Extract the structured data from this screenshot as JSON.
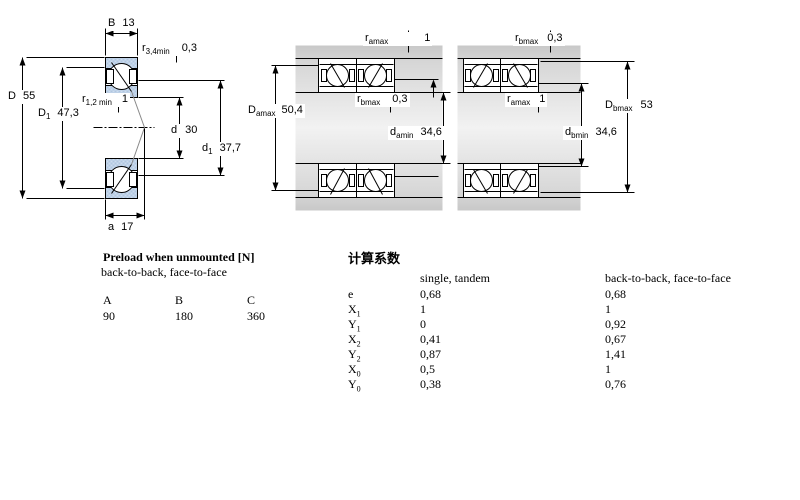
{
  "drawing": {
    "single": {
      "B": {
        "name": "B",
        "sub": "",
        "value": "13"
      },
      "r34": {
        "name": "r",
        "sub": "3,4min",
        "value": "0,3"
      },
      "D": {
        "name": "D",
        "sub": "",
        "value": "55"
      },
      "r12": {
        "name": "r",
        "sub": "1,2 min",
        "value": "1"
      },
      "D1": {
        "name": "D",
        "sub": "1",
        "value": "47,3"
      },
      "d": {
        "name": "d",
        "sub": "",
        "value": "30"
      },
      "d1": {
        "name": "d",
        "sub": "1",
        "value": "37,7"
      },
      "a": {
        "name": "a",
        "sub": "",
        "value": "17"
      }
    },
    "pair_a": {
      "ramax": {
        "name": "r",
        "sub": "amax",
        "value": "1"
      },
      "Damax": {
        "name": "D",
        "sub": "amax",
        "value": "50,4"
      },
      "rbmax": {
        "name": "r",
        "sub": "bmax",
        "value": "0,3"
      },
      "damin": {
        "name": "d",
        "sub": "amin",
        "value": "34,6"
      }
    },
    "pair_b": {
      "rbmax": {
        "name": "r",
        "sub": "bmax",
        "value": "0,3"
      },
      "ramax": {
        "name": "r",
        "sub": "amax",
        "value": "1"
      },
      "dbmin": {
        "name": "d",
        "sub": "bmin",
        "value": "34,6"
      },
      "Dbmax": {
        "name": "D",
        "sub": "bmax",
        "value": "53"
      }
    }
  },
  "preload_table": {
    "title": "Preload when unmounted [N]",
    "subtitle": "back-to-back, face-to-face",
    "columns": [
      "A",
      "B",
      "C"
    ],
    "values": [
      "90",
      "180",
      "360"
    ]
  },
  "factors_table": {
    "title": "计算系数",
    "col1_header": "single, tandem",
    "col2_header": "back-to-back, face-to-face",
    "rows": [
      {
        "label": "e",
        "sub": "",
        "single": "0,68",
        "paired": "0,68"
      },
      {
        "label": "X",
        "sub": "1",
        "single": "1",
        "paired": "1"
      },
      {
        "label": "Y",
        "sub": "1",
        "single": "0",
        "paired": "0,92"
      },
      {
        "label": "X",
        "sub": "2",
        "single": "0,41",
        "paired": "0,67"
      },
      {
        "label": "Y",
        "sub": "2",
        "single": "0,87",
        "paired": "1,41"
      },
      {
        "label": "X",
        "sub": "0",
        "single": "0,5",
        "paired": "1"
      },
      {
        "label": "Y",
        "sub": "0",
        "single": "0,38",
        "paired": "0,76"
      }
    ]
  },
  "colors": {
    "ring_fill": "#b0c6e0",
    "ring_fill_light": "#cddcee",
    "band_gray": "#d4d4d4",
    "line": "#000000"
  }
}
